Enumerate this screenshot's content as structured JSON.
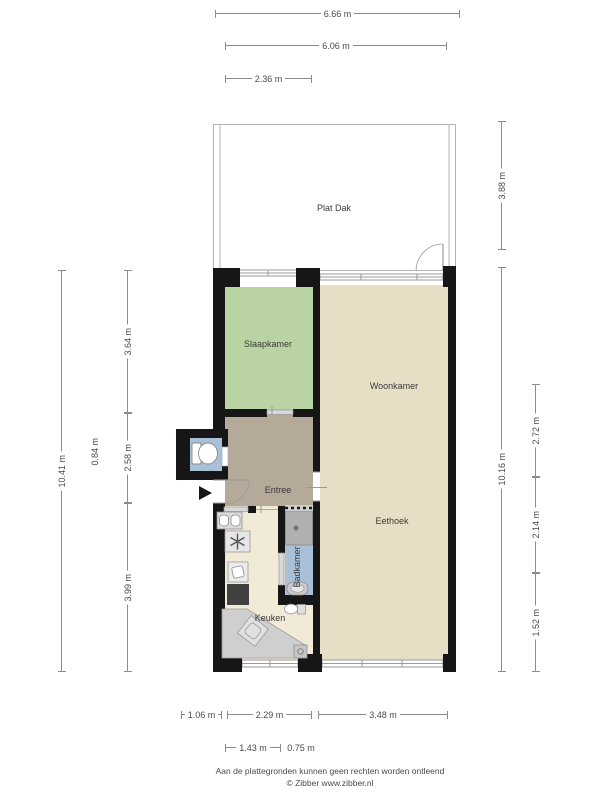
{
  "floorplan": {
    "rooms": [
      {
        "id": "plat-dak",
        "label": "Plat Dak"
      },
      {
        "id": "slaapkamer",
        "label": "Slaapkamer"
      },
      {
        "id": "woonkamer",
        "label": "Woonkamer"
      },
      {
        "id": "entree",
        "label": "Entree"
      },
      {
        "id": "eethoek",
        "label": "Eethoek"
      },
      {
        "id": "keuken",
        "label": "Keuken"
      },
      {
        "id": "badkamer",
        "label": "Badkamer"
      }
    ],
    "icons": [
      "toilet-icon",
      "shower-icon",
      "washbasin-icon",
      "boiler-star-icon",
      "stove-icon",
      "kitchen-counter-icon",
      "entrance-arrow-icon",
      "door-swing-icon",
      "window-icon"
    ],
    "colors": {
      "wall": "#161616",
      "slaapkamer": "#b9d3a3",
      "woonkamer": "#e7dfc5",
      "entree": "#b5a99a",
      "keuken": "#f1ead6",
      "badkamer": "#a9c0d9",
      "shower": "#b0b0b0",
      "dimension_line": "#8c8c8c"
    }
  },
  "dimensions": {
    "top": [
      {
        "label": "6.66 m"
      },
      {
        "label": "6.06 m"
      },
      {
        "label": "2.36 m"
      }
    ],
    "bottom": [
      {
        "label": "1.06 m"
      },
      {
        "label": "2.29 m"
      },
      {
        "label": "3.48 m"
      },
      {
        "label": "1.43 m"
      },
      {
        "label": "0.75 m"
      }
    ],
    "left": [
      {
        "label": "10.41 m"
      },
      {
        "label": "0.84 m"
      },
      {
        "label": "3.64 m"
      },
      {
        "label": "2.58 m"
      },
      {
        "label": "3.99 m"
      }
    ],
    "right": [
      {
        "label": "3.88 m"
      },
      {
        "label": "10.16 m"
      },
      {
        "label": "2.72 m"
      },
      {
        "label": "2.14 m"
      },
      {
        "label": "1.52 m"
      }
    ]
  },
  "footer": {
    "disclaimer": "Aan de plattegronden kunnen geen rechten worden ontleend",
    "credit": "© Zibber www.zibber.nl"
  }
}
